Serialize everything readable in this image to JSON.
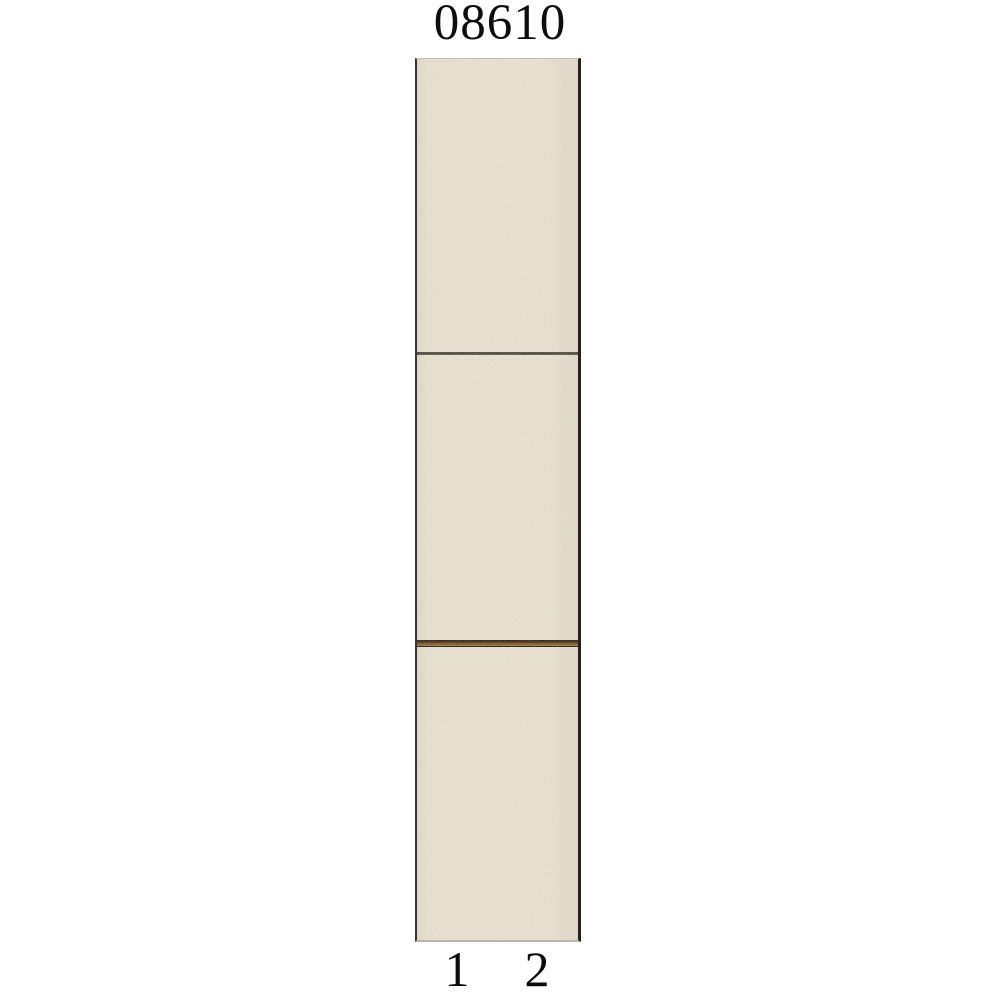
{
  "catalog_item": {
    "article_number": "08610",
    "scale_labels": [
      "1",
      "2"
    ],
    "panel": {
      "description": "vertical-wallpaper-panel-sample",
      "base_color": "#e6dfd0",
      "edge_color_left": "#3b372e",
      "edge_color_right": "#262219",
      "sections": [
        {
          "name": "top-section"
        },
        {
          "name": "middle-section"
        },
        {
          "name": "bottom-section"
        }
      ],
      "dividers": [
        {
          "name": "thin-seam-line",
          "color": "#4a443a"
        },
        {
          "name": "brown-trim-band",
          "colors": [
            "#2e2315",
            "#7d5930",
            "#a8854f",
            "#241a0e"
          ]
        }
      ]
    }
  }
}
